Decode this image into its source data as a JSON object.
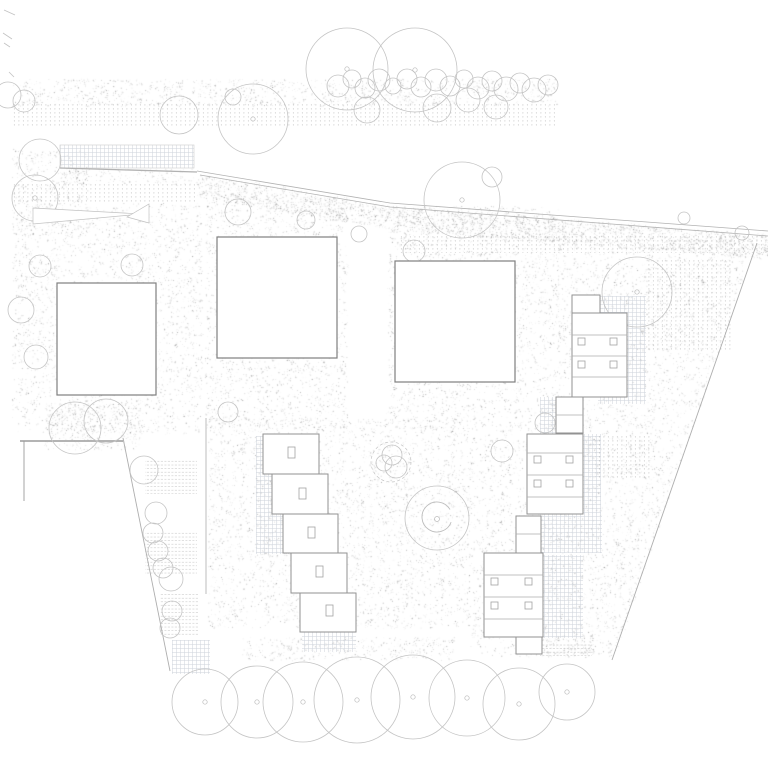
{
  "title": "Landscape site plan drawing",
  "colors": {
    "background": "#ffffff",
    "square_line": "#7f7f7f",
    "building_line": "#929292",
    "window_line": "#a2a2a2",
    "divider_line": "#ababab",
    "tree_line": "#c4c4c4",
    "tree_dot_line": "#bbbbbb",
    "road_line": "#b2b2b2",
    "boundary_line": "#aeaeae",
    "wall_line": "#9b9b9b",
    "mark_line": "#c2c2c2",
    "grid": "#ccd2da",
    "dots": "#b4b4b4",
    "hline": "#c8c8c8",
    "stipple": "#8a8a8a"
  },
  "site_plan": {
    "canvas_size": 768,
    "textures": [
      {
        "type": "stipple",
        "rect": [
          12,
          79,
          546,
          27
        ],
        "density": 14
      },
      {
        "type": "dots",
        "rect": [
          12,
          104,
          546,
          23
        ]
      },
      {
        "type": "stipple",
        "rect": [
          12,
          150,
          76,
          86
        ],
        "density": 16
      },
      {
        "type": "stipple",
        "rect": [
          60,
          168,
          134,
          16
        ],
        "density": 17
      },
      {
        "type": "dots",
        "rect": [
          12,
          183,
          183,
          21
        ]
      },
      {
        "type": "stipple",
        "poly": [
          [
            197,
            174
          ],
          [
            390,
            206
          ],
          [
            768,
            234
          ],
          [
            768,
            259
          ],
          [
            390,
            229
          ],
          [
            197,
            197
          ]
        ],
        "density": 15
      },
      {
        "type": "dots",
        "rect": [
          400,
          236,
          368,
          17
        ]
      },
      {
        "type": "stipple",
        "rect": [
          12,
          203,
          190,
          230
        ],
        "density": 17
      },
      {
        "type": "stipple",
        "rect": [
          205,
          196,
          143,
          234
        ],
        "density": 17
      },
      {
        "type": "stipple",
        "rect": [
          388,
          206,
          172,
          226
        ],
        "density": 17
      },
      {
        "type": "stipple",
        "rect": [
          208,
          418,
          262,
          210
        ],
        "density": 17
      },
      {
        "type": "stipple",
        "poly": [
          [
            558,
            242
          ],
          [
            752,
            250
          ],
          [
            690,
            438
          ],
          [
            558,
            438
          ]
        ],
        "density": 16
      },
      {
        "type": "stipple",
        "poly": [
          [
            470,
            432
          ],
          [
            688,
            440
          ],
          [
            616,
            656
          ],
          [
            470,
            656
          ]
        ],
        "density": 16
      },
      {
        "type": "stipple",
        "rect": [
          45,
          403,
          95,
          47
        ],
        "density": 12
      },
      {
        "type": "stipple",
        "rect": [
          242,
          637,
          212,
          23
        ],
        "density": 14
      },
      {
        "type": "stipple",
        "rect": [
          514,
          636,
          80,
          21
        ],
        "density": 15
      },
      {
        "type": "grid",
        "rect": [
          60,
          145,
          134,
          23
        ],
        "outlined": true
      },
      {
        "type": "grid",
        "rect": [
          598,
          296,
          48,
          108
        ]
      },
      {
        "type": "grid",
        "rect": [
          540,
          397,
          34,
          44
        ]
      },
      {
        "type": "grid",
        "rect": [
          583,
          434,
          18,
          80
        ]
      },
      {
        "type": "grid",
        "rect": [
          540,
          513,
          62,
          40
        ]
      },
      {
        "type": "grid",
        "rect": [
          543,
          555,
          40,
          83
        ]
      },
      {
        "type": "grid",
        "rect": [
          172,
          640,
          38,
          34
        ]
      },
      {
        "type": "grid",
        "rect": [
          256,
          436,
          34,
          118
        ]
      },
      {
        "type": "grid",
        "rect": [
          302,
          632,
          54,
          20
        ]
      },
      {
        "type": "dots",
        "rect": [
          645,
          258,
          88,
          92
        ]
      },
      {
        "type": "dots",
        "rect": [
          595,
          435,
          55,
          45
        ]
      },
      {
        "type": "hlines",
        "rect": [
          145,
          460,
          52,
          34
        ]
      },
      {
        "type": "hlines",
        "rect": [
          145,
          531,
          52,
          45
        ]
      },
      {
        "type": "hlines",
        "rect": [
          160,
          594,
          38,
          43
        ]
      },
      {
        "type": "hlines",
        "rect": [
          540,
          642,
          52,
          14
        ]
      }
    ],
    "roads": [
      {
        "points": [
          [
            197,
            171
          ],
          [
            390,
            203
          ],
          [
            768,
            231
          ]
        ],
        "width": 0.8
      },
      {
        "points": [
          [
            200,
            175
          ],
          [
            390,
            207
          ],
          [
            768,
            236
          ]
        ],
        "width": 0.8
      },
      {
        "points": [
          [
            60,
            168
          ],
          [
            197,
            172
          ]
        ],
        "width": 1.3
      }
    ],
    "boundaries": [
      {
        "points": [
          [
            123,
            438
          ],
          [
            170,
            671
          ]
        ],
        "width": 0.9
      },
      {
        "points": [
          [
            757,
            243
          ],
          [
            612,
            660
          ]
        ],
        "width": 0.9
      },
      {
        "points": [
          [
            206,
            418
          ],
          [
            206,
            594
          ]
        ],
        "width": 0.8
      }
    ],
    "walls": [
      {
        "points": [
          [
            20,
            441
          ],
          [
            123,
            441
          ]
        ],
        "width": 1.6
      },
      {
        "points": [
          [
            24,
            441
          ],
          [
            24,
            501
          ]
        ],
        "width": 0.9
      }
    ],
    "ticks": [
      [
        4,
        10,
        15,
        15
      ],
      [
        3,
        33,
        12,
        39
      ],
      [
        4,
        43,
        10,
        47
      ],
      [
        9,
        72,
        14,
        77
      ]
    ],
    "trees": [
      [
        347,
        69,
        41
      ],
      [
        415,
        70,
        42
      ],
      [
        179,
        115,
        19
      ],
      [
        253,
        119,
        35
      ],
      [
        233,
        97,
        8
      ],
      [
        367,
        110,
        13
      ],
      [
        437,
        108,
        14
      ],
      [
        8,
        95,
        13
      ],
      [
        24,
        101,
        11
      ],
      [
        338,
        86,
        11
      ],
      [
        352,
        79,
        9
      ],
      [
        365,
        88,
        10
      ],
      [
        379,
        80,
        11
      ],
      [
        393,
        86,
        8
      ],
      [
        407,
        79,
        10
      ],
      [
        421,
        87,
        10
      ],
      [
        436,
        80,
        11
      ],
      [
        450,
        86,
        10
      ],
      [
        464,
        79,
        9
      ],
      [
        478,
        88,
        11
      ],
      [
        492,
        81,
        10
      ],
      [
        506,
        89,
        12
      ],
      [
        520,
        83,
        10
      ],
      [
        534,
        90,
        12
      ],
      [
        548,
        85,
        10
      ],
      [
        468,
        100,
        12
      ],
      [
        496,
        107,
        12
      ],
      [
        40,
        160,
        21
      ],
      [
        35,
        198,
        23
      ],
      [
        40,
        266,
        11
      ],
      [
        132,
        265,
        11
      ],
      [
        21,
        310,
        13
      ],
      [
        36,
        357,
        12
      ],
      [
        238,
        212,
        13
      ],
      [
        306,
        220,
        9
      ],
      [
        359,
        234,
        8
      ],
      [
        462,
        200,
        38
      ],
      [
        492,
        177,
        10
      ],
      [
        414,
        251,
        11
      ],
      [
        637,
        292,
        35
      ],
      [
        684,
        218,
        6
      ],
      [
        742,
        233,
        7
      ],
      [
        228,
        412,
        10
      ],
      [
        144,
        470,
        14
      ],
      [
        156,
        513,
        11
      ],
      [
        153,
        533,
        10
      ],
      [
        158,
        551,
        10
      ],
      [
        163,
        568,
        10
      ],
      [
        171,
        579,
        12
      ],
      [
        172,
        611,
        10
      ],
      [
        170,
        628,
        10
      ],
      [
        502,
        451,
        11
      ],
      [
        545,
        423,
        10
      ],
      [
        75,
        428,
        26
      ],
      [
        106,
        421,
        22
      ],
      [
        205,
        702,
        33
      ],
      [
        257,
        702,
        36
      ],
      [
        303,
        702,
        40
      ],
      [
        357,
        700,
        43
      ],
      [
        413,
        697,
        42
      ],
      [
        467,
        698,
        38
      ],
      [
        519,
        704,
        36
      ],
      [
        567,
        692,
        28
      ]
    ],
    "tree_center_dots": [
      [
        347,
        69
      ],
      [
        415,
        70
      ],
      [
        253,
        119
      ],
      [
        462,
        200
      ],
      [
        637,
        292
      ],
      [
        35,
        198
      ],
      [
        205,
        702
      ],
      [
        257,
        702
      ],
      [
        303,
        702
      ],
      [
        357,
        700
      ],
      [
        413,
        697
      ],
      [
        467,
        698
      ],
      [
        519,
        704
      ],
      [
        567,
        692
      ]
    ],
    "shrub_cluster": {
      "circles": [
        [
          392,
          455,
          10
        ],
        [
          384,
          463,
          8
        ],
        [
          396,
          467,
          11
        ]
      ],
      "arc": [
        391,
        462,
        20
      ]
    },
    "swirl": {
      "cx": 437,
      "cy": 517,
      "outer_r": 32,
      "inner_r": 15,
      "start": 20,
      "end": 330,
      "dot_r": 2.5
    },
    "wedge_marks": [
      [
        [
          33,
          208
        ],
        [
          142,
          214
        ],
        [
          33,
          224
        ]
      ],
      [
        [
          149,
          204
        ],
        [
          149,
          223
        ],
        [
          127,
          217
        ]
      ]
    ],
    "buildings": {
      "squares": [
        {
          "x": 57,
          "y": 283,
          "w": 99,
          "h": 112
        },
        {
          "x": 217,
          "y": 237,
          "w": 120,
          "h": 121
        },
        {
          "x": 395,
          "y": 261,
          "w": 120,
          "h": 121
        }
      ],
      "terrace_houses": [
        {
          "x": 263,
          "y": 434,
          "w": 56,
          "h": 40,
          "win": [
            288,
            447
          ]
        },
        {
          "x": 272,
          "y": 474,
          "w": 56,
          "h": 40,
          "win": [
            299,
            488
          ]
        },
        {
          "x": 283,
          "y": 514,
          "w": 55,
          "h": 39,
          "win": [
            308,
            527
          ]
        },
        {
          "x": 291,
          "y": 553,
          "w": 56,
          "h": 40,
          "win": [
            316,
            566
          ]
        },
        {
          "x": 300,
          "y": 593,
          "w": 56,
          "h": 39,
          "win": [
            326,
            605
          ]
        }
      ],
      "clusters": [
        {
          "parts": [
            {
              "x": 572,
              "y": 295,
              "w": 28,
              "h": 18
            },
            {
              "x": 572,
              "y": 313,
              "w": 55,
              "h": 84,
              "dividers": [
                335,
                356,
                377
              ],
              "windows": [
                [
                  578,
                  338
                ],
                [
                  610,
                  338
                ],
                [
                  578,
                  361
                ],
                [
                  610,
                  361
                ]
              ]
            },
            {
              "x": 556,
              "y": 397,
              "w": 27,
              "h": 36,
              "dividers": [
                415
              ]
            }
          ]
        },
        {
          "parts": [
            {
              "x": 527,
              "y": 434,
              "w": 56,
              "h": 80,
              "dividers": [
                453,
                475,
                497
              ],
              "windows": [
                [
                  534,
                  456
                ],
                [
                  566,
                  456
                ],
                [
                  534,
                  480
                ],
                [
                  566,
                  480
                ]
              ]
            },
            {
              "x": 516,
              "y": 516,
              "w": 25,
              "h": 37,
              "dividers": [
                534
              ]
            }
          ]
        },
        {
          "parts": [
            {
              "x": 484,
              "y": 553,
              "w": 59,
              "h": 84,
              "dividers": [
                575,
                597,
                619
              ],
              "windows": [
                [
                  491,
                  578
                ],
                [
                  525,
                  578
                ],
                [
                  491,
                  602
                ],
                [
                  525,
                  602
                ]
              ]
            },
            {
              "x": 516,
              "y": 637,
              "w": 26,
              "h": 17
            }
          ]
        }
      ],
      "window_size": [
        7,
        7
      ],
      "terrace_window_size": [
        7,
        11
      ]
    }
  }
}
